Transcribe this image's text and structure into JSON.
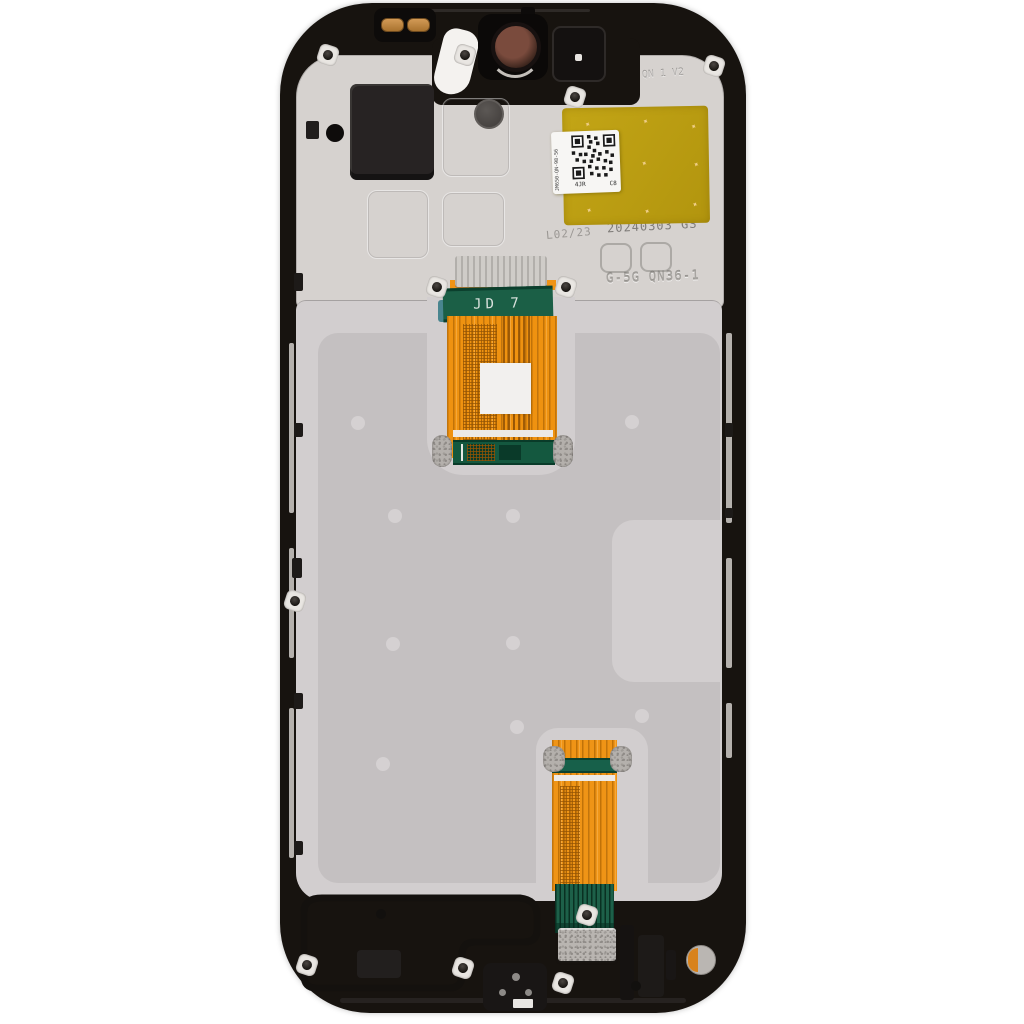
{
  "image": {
    "type": "product-photo",
    "subject": "Smartphone LCD screen and digitizer assembly with frame, rear view",
    "background_color": "#ffffff"
  },
  "markings": {
    "date_code": "20240303 GS",
    "model_code": "G-5G QN36-1",
    "flex_cable_label": "JD 7",
    "mold_stamp": "L02/23",
    "frame_emboss": "QN 1 V2",
    "qr_label": {
      "side_text": "JM650-QN-98-56",
      "bottom_left": "4JR",
      "bottom_right": "C8"
    }
  },
  "colors": {
    "frame_black": "#17130f",
    "plate_light": "#d6d2cf",
    "plate_recessed": "#c4c0c1",
    "dimple_gray": "#d5d1d2",
    "sticker_yellow": "#bc9f12",
    "flex_orange": "#ef9416",
    "flex_green": "#1b5f46",
    "label_white": "#f6f4f2",
    "camera_lens_brown": "#6b4438",
    "contact_gold": "#c08a4a"
  }
}
